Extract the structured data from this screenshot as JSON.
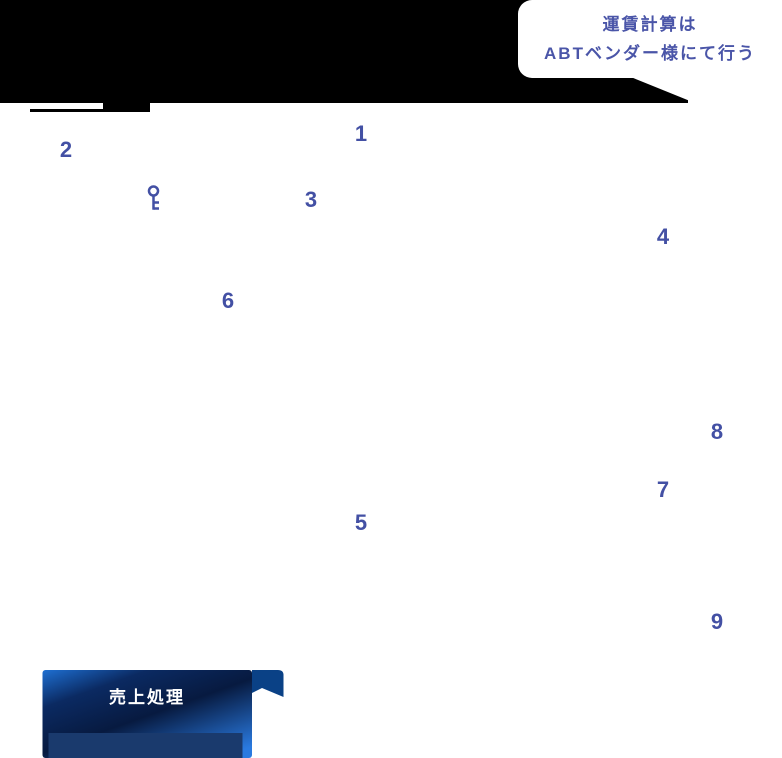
{
  "bubble": {
    "line1": "運賃計算は",
    "line2": "ABTベンダー様にて行う"
  },
  "steps": [
    "1",
    "2",
    "3",
    "4",
    "5",
    "6",
    "7",
    "8",
    "9"
  ],
  "button": {
    "label": "売上処理"
  },
  "icons": {
    "key": "key-icon"
  },
  "colors": {
    "step_number": "#4350a4",
    "bubble_text": "#4a55a8",
    "bubble_bg": "#ffffff",
    "mask_black": "#000000",
    "button_bright_blue": "#1e6fd2",
    "button_dark_navy": "#071a40",
    "button_bottom_bar": "#1a3a6d",
    "button_tab": "#0a4186",
    "button_label": "#ffffff"
  }
}
